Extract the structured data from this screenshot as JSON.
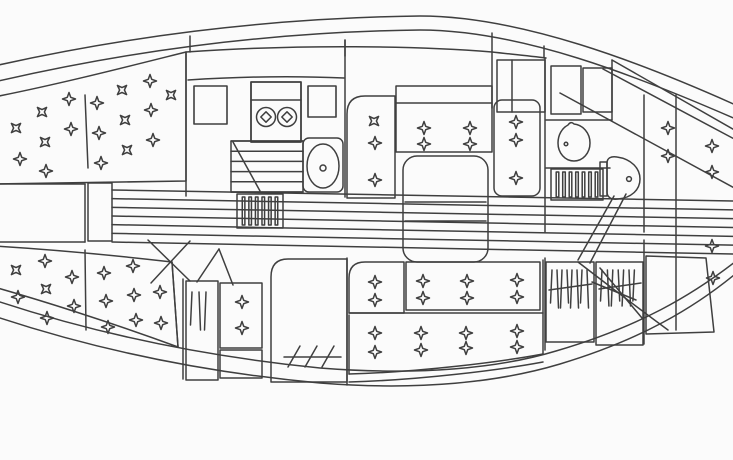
{
  "meta": {
    "description": "Sailboat interior accommodation plan, top view line drawing, bow at left",
    "visible_text": ""
  },
  "colors": {
    "paper": "#fbfbfb",
    "ink": "#3f3f3f",
    "ink_soft": "#5a5a5a",
    "grate_fill": "#1c1c1c"
  },
  "fixtures": [
    "v-berth",
    "galley-stove",
    "galley-sink",
    "galley-lockers",
    "companionway-grate",
    "dinette-u-settee",
    "saloon-drop-leaf-table",
    "starboard-settee",
    "chart-table",
    "nav-seat",
    "hanging-lockers",
    "head-sink",
    "shower-grate",
    "toilet",
    "quarter-berths"
  ],
  "diagram": {
    "tuft_star_size": 6.5,
    "tuft_groups": {
      "v-berth-port-tufts": [
        [
          16,
          128,
          45
        ],
        [
          42,
          112,
          45
        ],
        [
          69,
          99,
          0
        ],
        [
          20,
          159,
          0
        ],
        [
          45,
          142,
          45
        ],
        [
          71,
          129,
          0
        ],
        [
          46,
          171,
          0
        ],
        [
          97,
          103,
          0
        ],
        [
          122,
          90,
          45
        ],
        [
          150,
          81,
          0
        ],
        [
          99,
          133,
          0
        ],
        [
          125,
          120,
          45
        ],
        [
          151,
          110,
          0
        ],
        [
          101,
          163,
          0
        ],
        [
          127,
          150,
          45
        ],
        [
          153,
          140,
          0
        ],
        [
          171,
          95,
          45
        ]
      ],
      "v-berth-starboard-tufts": [
        [
          16,
          270,
          45
        ],
        [
          45,
          261,
          0
        ],
        [
          72,
          277,
          0
        ],
        [
          18,
          297,
          0
        ],
        [
          46,
          289,
          45
        ],
        [
          74,
          306,
          0
        ],
        [
          47,
          318,
          0
        ],
        [
          104,
          273,
          0
        ],
        [
          133,
          266,
          0
        ],
        [
          160,
          292,
          0
        ],
        [
          106,
          301,
          0
        ],
        [
          134,
          295,
          0
        ],
        [
          108,
          327,
          0
        ],
        [
          136,
          320,
          0
        ],
        [
          161,
          323,
          0
        ]
      ],
      "dinette-left-tufts": [
        [
          374,
          121,
          45
        ],
        [
          375,
          143,
          0
        ],
        [
          375,
          180,
          0
        ]
      ],
      "dinette-back-tufts": [
        [
          424,
          128,
          0
        ],
        [
          424,
          144,
          0
        ],
        [
          470,
          128,
          0
        ],
        [
          470,
          144,
          0
        ]
      ],
      "dinette-right-tufts": [
        [
          516,
          122,
          0
        ],
        [
          516,
          140,
          0
        ],
        [
          516,
          178,
          0
        ]
      ],
      "settee-back-left-tufts": [
        [
          375,
          282,
          0
        ],
        [
          375,
          300,
          0
        ]
      ],
      "settee-back-long-tufts": [
        [
          423,
          281,
          0
        ],
        [
          423,
          298,
          0
        ],
        [
          467,
          281,
          0
        ],
        [
          467,
          298,
          0
        ],
        [
          517,
          280,
          0
        ],
        [
          517,
          297,
          0
        ]
      ],
      "settee-seat-tufts": [
        [
          375,
          333,
          0
        ],
        [
          375,
          352,
          0
        ],
        [
          421,
          333,
          0
        ],
        [
          421,
          350,
          0
        ],
        [
          466,
          333,
          0
        ],
        [
          466,
          348,
          0
        ],
        [
          517,
          331,
          0
        ],
        [
          517,
          347,
          0
        ]
      ],
      "nav-seat-tufts": [
        [
          242,
          302,
          0
        ],
        [
          242,
          328,
          0
        ]
      ],
      "aft-berth-port-tufts": [
        [
          668,
          128,
          0
        ],
        [
          668,
          156,
          0
        ],
        [
          712,
          146,
          0
        ],
        [
          712,
          172,
          0
        ]
      ],
      "aft-berth-starboard-tufts": [
        [
          712,
          246,
          0
        ],
        [
          713,
          278,
          0
        ]
      ]
    },
    "burners": {
      "group": "stove-burners",
      "items": [
        [
          266,
          117
        ],
        [
          287,
          117
        ]
      ],
      "radius": 9.5,
      "diamond": 5.2
    },
    "grates": [
      {
        "group": "companionway-grate",
        "x": 237,
        "y": 194,
        "w": 46,
        "h": 34,
        "slits": 6
      },
      {
        "group": "shower-grate",
        "x": 551,
        "y": 169,
        "w": 52,
        "h": 31,
        "slits": 7
      }
    ],
    "plank_bands": [
      {
        "group": "cabin-sole-planking",
        "x1": 112,
        "x2": 733,
        "y_top_start": 190,
        "y_top_end": 201,
        "y_bot_start": 242,
        "y_bot_end": 254,
        "inner": 5
      },
      {
        "group": "galley-counter-stripes",
        "x1": 231,
        "x2": 303,
        "y_top_start": 141,
        "y_top_end": 141,
        "y_bot_start": 192,
        "y_bot_end": 192,
        "inner": 4
      }
    ],
    "hanger_racks": [
      {
        "group": "fwd-hanging-locker-contents",
        "x": 192,
        "y": 292,
        "count": 3,
        "step": 7,
        "len": 38,
        "rail": null
      },
      {
        "group": "aft-hanging-locker-1-contents",
        "x": 552,
        "y": 270,
        "count": 8,
        "step": 5,
        "len": 38,
        "rail": [
          549,
          290,
          592,
          284
        ]
      },
      {
        "group": "aft-hanging-locker-2-contents",
        "x": 602,
        "y": 270,
        "count": 7,
        "step": 5.4,
        "len": 36,
        "rail": [
          599,
          289,
          641,
          283
        ]
      }
    ]
  }
}
